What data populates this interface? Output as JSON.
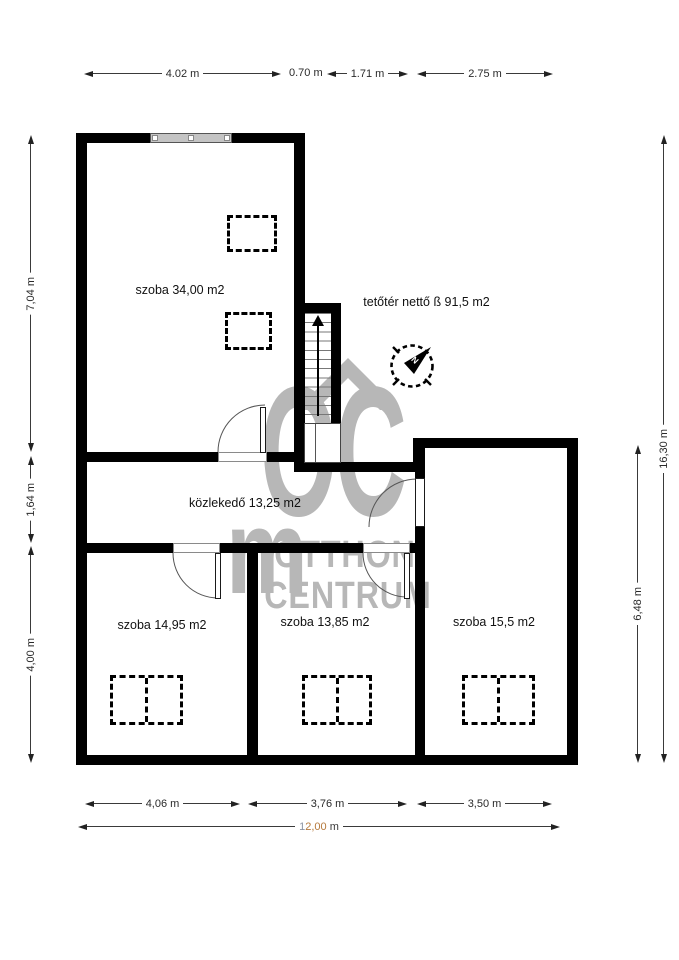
{
  "floorplan": {
    "rooms": {
      "room_top": "szoba 34,00 m2",
      "attic": "tetőtér nettő ß 91,5 m2",
      "hall": "közlekedő 13,25 m2",
      "room_bottom_left": "szoba 14,95 m2",
      "room_bottom_middle": "szoba 13,85 m2",
      "room_bottom_right": "szoba 15,5 m2"
    },
    "dims": {
      "top": [
        "4.02 m",
        "0.70 m",
        "1.71 m",
        "2.75 m"
      ],
      "left": [
        "7,04 m",
        "1,64 m",
        "4,00 m"
      ],
      "right_outer": "16,30 m",
      "right_inner": "6,48 m",
      "bottom": [
        "4,06 m",
        "3,76 m",
        "3,50 m"
      ],
      "bottom_total": {
        "p1": "1",
        "p2": "2,00",
        "p3": " m"
      }
    },
    "watermark": {
      "letters": "OC",
      "word1": "OTTHON",
      "word2": "CENTRUM",
      "arch": "m"
    },
    "compass": {
      "needle_label": "N"
    },
    "colors": {
      "wall": "#000000",
      "watermark": "#b7b7b7",
      "dim_text": "#2a2a2a",
      "total_part1": "#8a93a3",
      "total_part2": "#b5793c",
      "window_fill": "#c4c4c4"
    }
  }
}
